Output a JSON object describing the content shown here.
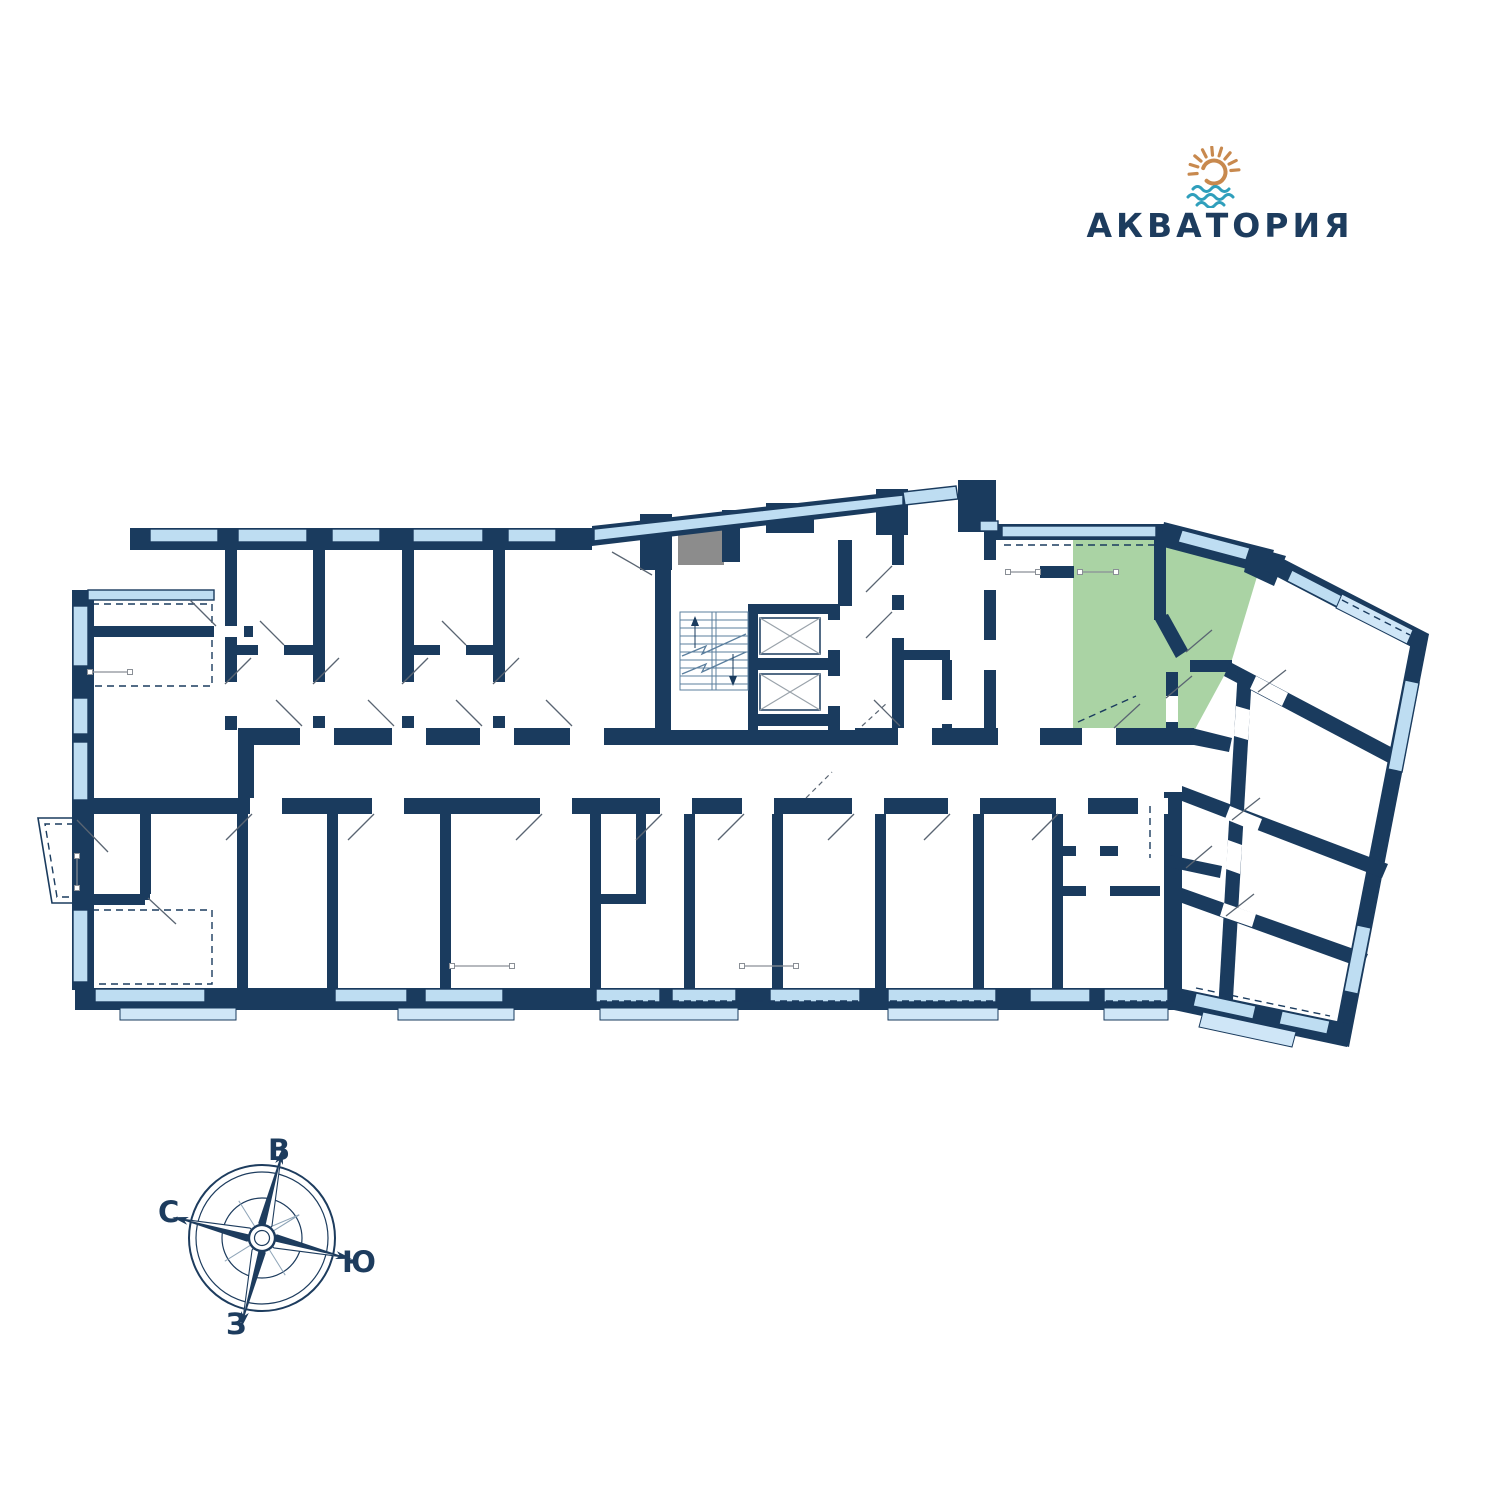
{
  "logo": {
    "name": "АКВАТОРИЯ"
  },
  "compass": {
    "labels": {
      "top": "В",
      "left": "С",
      "right": "Ю",
      "bottom": "З"
    }
  },
  "colors": {
    "wall": "#1A3B5E",
    "window": "#BEDDF2",
    "balcony": "#CFE6F7",
    "green": "#AAD3A4",
    "shaft": "#8C8C8C",
    "stair": "#5B7F9E",
    "door": "#5A6572",
    "logoSun": "#C8894E",
    "logoWave": "#2F9FBC",
    "text": "#1D3C5E",
    "elevator": "#9AA3AB",
    "sym": "#8A8F96"
  }
}
